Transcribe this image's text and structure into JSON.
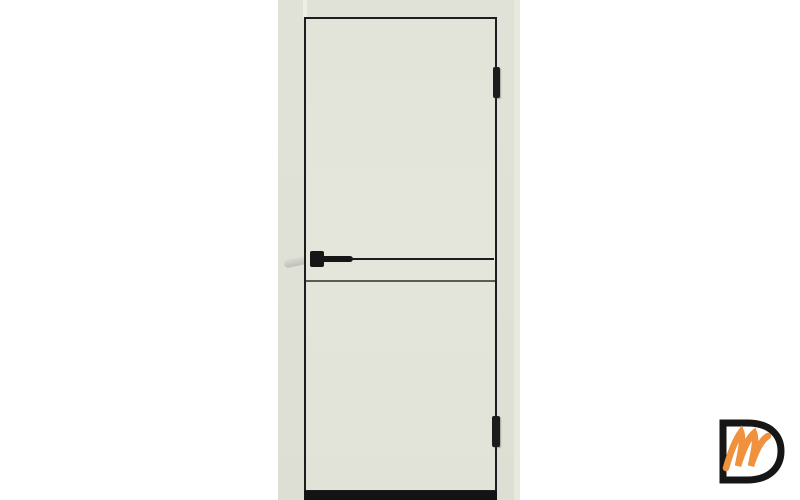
{
  "page": {
    "background_color": "#ffffff"
  },
  "product_photo": {
    "description": "Front view of a light painted interior door with black edge trim, black horizontal molding strip at handle height, black square handle and two black hinges on the right side",
    "background_color": "#dfe1d7",
    "door": {
      "face_color": "#e3e5db",
      "trim_color": "#1d1d1d",
      "molding_strip_color": "#1c1c1c",
      "handle_color": "#161616",
      "outer_lever_color": "#c7c9c3",
      "hinge_color": "#1c1c1c",
      "bottom_edge_color": "#131313",
      "hinge_count": 2
    }
  },
  "watermark_logo": {
    "letter_d": "D",
    "letter_m": "m",
    "d_color": "#161616",
    "m_color": "#ef913d"
  }
}
